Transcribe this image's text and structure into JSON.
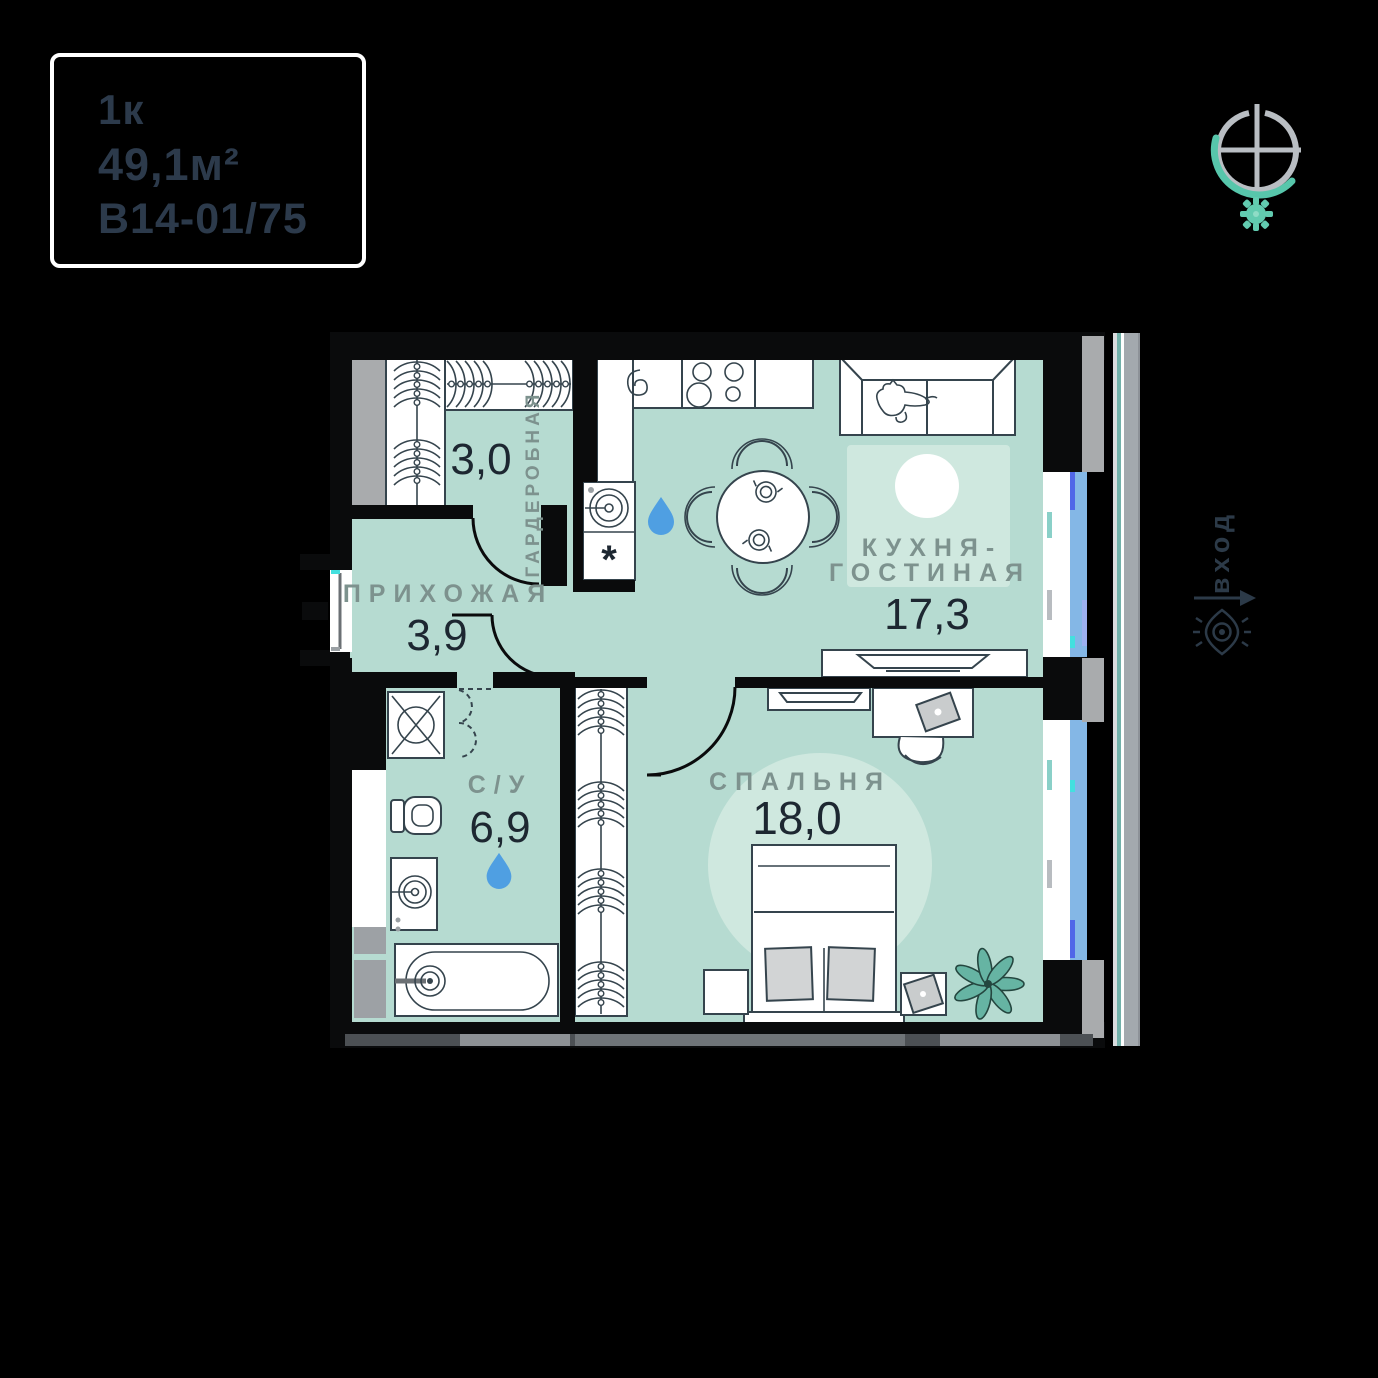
{
  "card": {
    "rooms_label": "1к",
    "area": "49,1м²",
    "unit_code": "В14-01/75"
  },
  "entrance": {
    "label": "вход"
  },
  "rooms": {
    "wardrobe": {
      "name": "ГАРДЕРОБНАЯ",
      "area": "3,0"
    },
    "hallway": {
      "name": "ПРИХОЖАЯ",
      "area": "3,9"
    },
    "bathroom": {
      "name": "С/У",
      "area": "6,9"
    },
    "kitchen_living": {
      "name_line1": "КУХНЯ-",
      "name_line2": "ГОСТИНАЯ",
      "area": "17,3"
    },
    "bedroom": {
      "name": "СПАЛЬНЯ",
      "area": "18,0"
    }
  },
  "symbols": {
    "dishwasher_mark": "*"
  },
  "colors": {
    "background": "#000000",
    "walls": "#0a0b0c",
    "floor": "#b6dbd1",
    "rug": "#cfe8df",
    "window_glass": "#84b7e6",
    "window_accent": "#5066e8",
    "window_cyan": "#43e0df",
    "label_text": "#7d928e",
    "area_text": "#1d2731",
    "card_text": "#2c3a4b",
    "logo_gray": "#b9bec3",
    "logo_teal": "#57c6ab",
    "pillar_gray": "#a9abad",
    "facade_gray": "#a3a9ae",
    "facade_teal": "#72b1aa",
    "plant": "#66b4a3",
    "water_drop": "#4f9fe2",
    "pillow_gray": "#d2d4d5"
  }
}
